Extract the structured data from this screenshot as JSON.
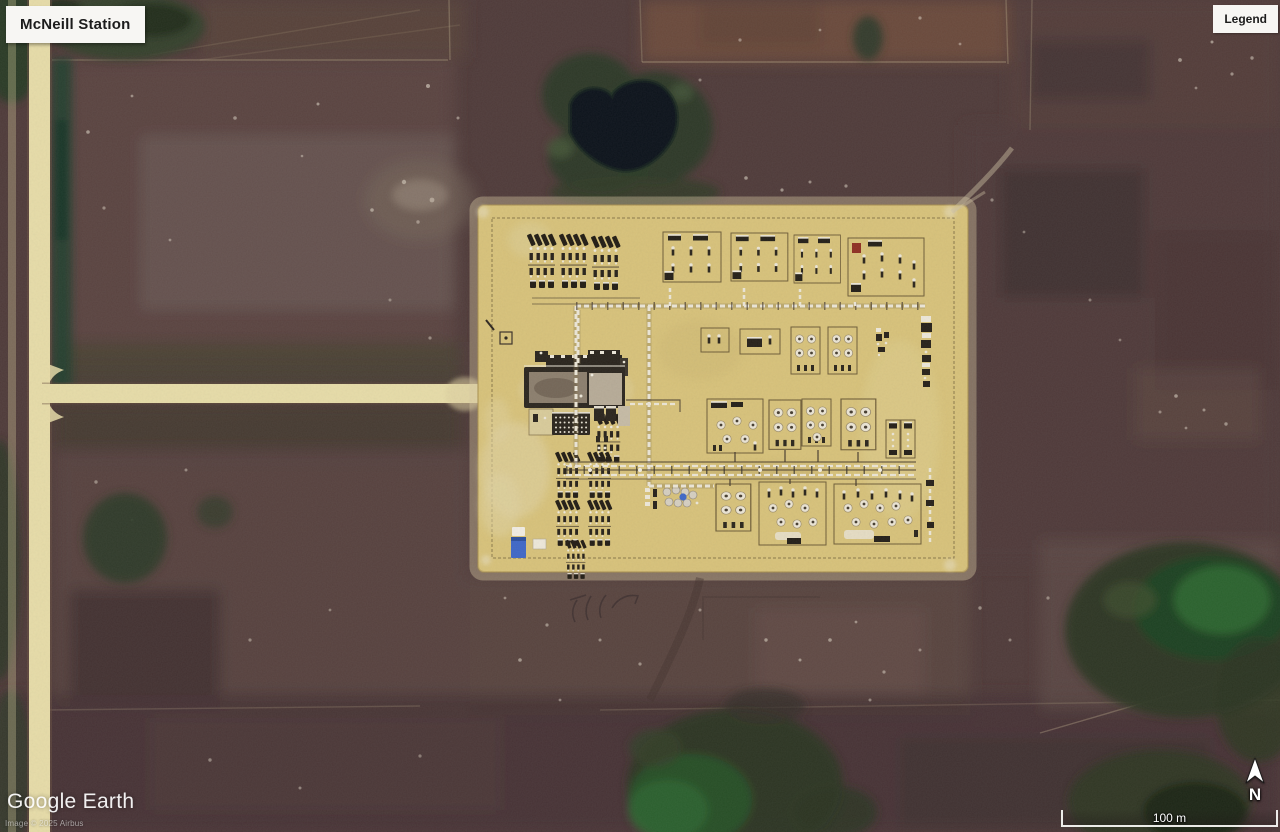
{
  "overlay": {
    "station_label": "McNeill Station",
    "legend_label": "Legend",
    "watermark": "Google Earth",
    "attribution": "Image © 2025 Airbus",
    "scale_label": "100 m",
    "north_label": "N"
  },
  "palette": {
    "sand": "#d8c37b",
    "sandLight": "#e7dcab",
    "sandDark": "#b89f58",
    "terrain": "#4f3b3a",
    "terrainDark": "#3c2e2f",
    "terrainLight": "#63504a",
    "fieldRed": "#6b4b3d",
    "green": "#2c3a27",
    "greenDark": "#1d2819",
    "greenBright": "#2e6b33",
    "pond": "#0b121b",
    "road": "#e7dda9",
    "equip": "#26211a",
    "white": "#efeadd",
    "accentRed": "#8f2f22",
    "truckBlue": "#3f68c8",
    "uiBg": "#f7f6f3",
    "uiText": "#1c1c1c"
  }
}
